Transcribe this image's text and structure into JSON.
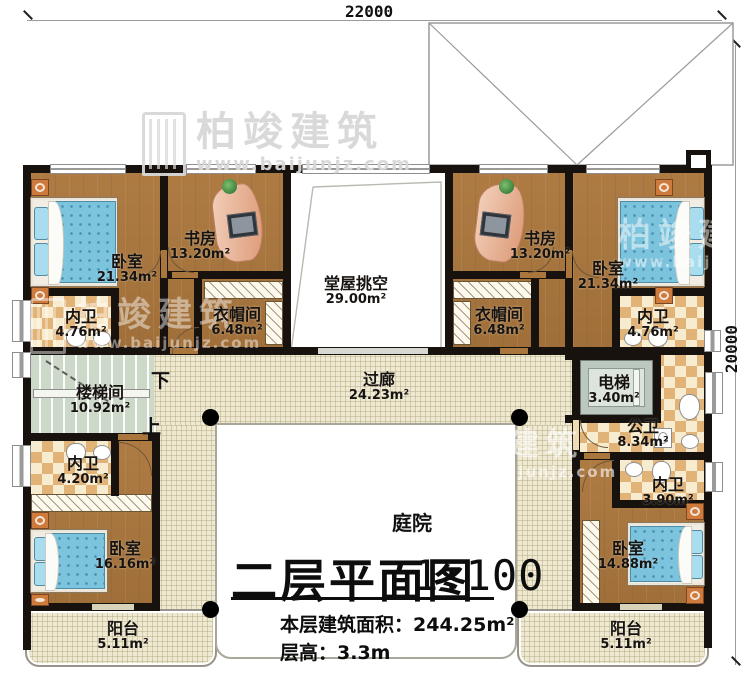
{
  "dimensions": {
    "top": "22000",
    "right": "20000"
  },
  "watermark": {
    "brand": "柏竣建筑",
    "url": "www.baijunjz.com"
  },
  "title": {
    "main": "二层平面图",
    "scale": "1:100",
    "area_label": "本层建筑面积：",
    "area_value": "244.25m²",
    "floor_height_label": "层高：",
    "floor_height_value": "3.3m"
  },
  "courtyard_label": "庭院",
  "stairs": {
    "down": "下",
    "up": "上"
  },
  "rooms": [
    {
      "id": "bedroom-top-left",
      "name": "卧室",
      "area": "21.34m²",
      "x": 127,
      "y": 254
    },
    {
      "id": "study-left",
      "name": "书房",
      "area": "13.20m²",
      "x": 200,
      "y": 231
    },
    {
      "id": "hall-void",
      "name": "堂屋挑空",
      "area": "29.00m²",
      "x": 356,
      "y": 276
    },
    {
      "id": "study-right",
      "name": "书房",
      "area": "13.20m²",
      "x": 540,
      "y": 231
    },
    {
      "id": "bedroom-top-right",
      "name": "卧室",
      "area": "21.34m²",
      "x": 608,
      "y": 261
    },
    {
      "id": "bath-top-left",
      "name": "内卫",
      "area": "4.76m²",
      "x": 81,
      "y": 309
    },
    {
      "id": "cloak-left",
      "name": "衣帽间",
      "area": "6.48m²",
      "x": 237,
      "y": 307
    },
    {
      "id": "cloak-right",
      "name": "衣帽间",
      "area": "6.48m²",
      "x": 499,
      "y": 307
    },
    {
      "id": "bath-top-right",
      "name": "内卫",
      "area": "4.76m²",
      "x": 653,
      "y": 309
    },
    {
      "id": "stairwell",
      "name": "楼梯间",
      "area": "10.92m²",
      "x": 100,
      "y": 385
    },
    {
      "id": "corridor",
      "name": "过廊",
      "area": "24.23m²",
      "x": 379,
      "y": 372
    },
    {
      "id": "elevator",
      "name": "电梯",
      "area": "3.40m²",
      "x": 614,
      "y": 375
    },
    {
      "id": "public-bath",
      "name": "公卫",
      "area": "8.34m²",
      "x": 643,
      "y": 419
    },
    {
      "id": "bath-mid-left",
      "name": "内卫",
      "area": "4.20m²",
      "x": 83,
      "y": 456
    },
    {
      "id": "bath-mid-right",
      "name": "内卫",
      "area": "3.90m²",
      "x": 668,
      "y": 477
    },
    {
      "id": "bedroom-bottom-left",
      "name": "卧室",
      "area": "16.16m²",
      "x": 125,
      "y": 541
    },
    {
      "id": "bedroom-bottom-right",
      "name": "卧室",
      "area": "14.88m²",
      "x": 628,
      "y": 541
    },
    {
      "id": "balcony-left",
      "name": "阳台",
      "area": "5.11m²",
      "x": 123,
      "y": 621
    },
    {
      "id": "balcony-right",
      "name": "阳台",
      "area": "5.11m²",
      "x": 626,
      "y": 621
    }
  ]
}
